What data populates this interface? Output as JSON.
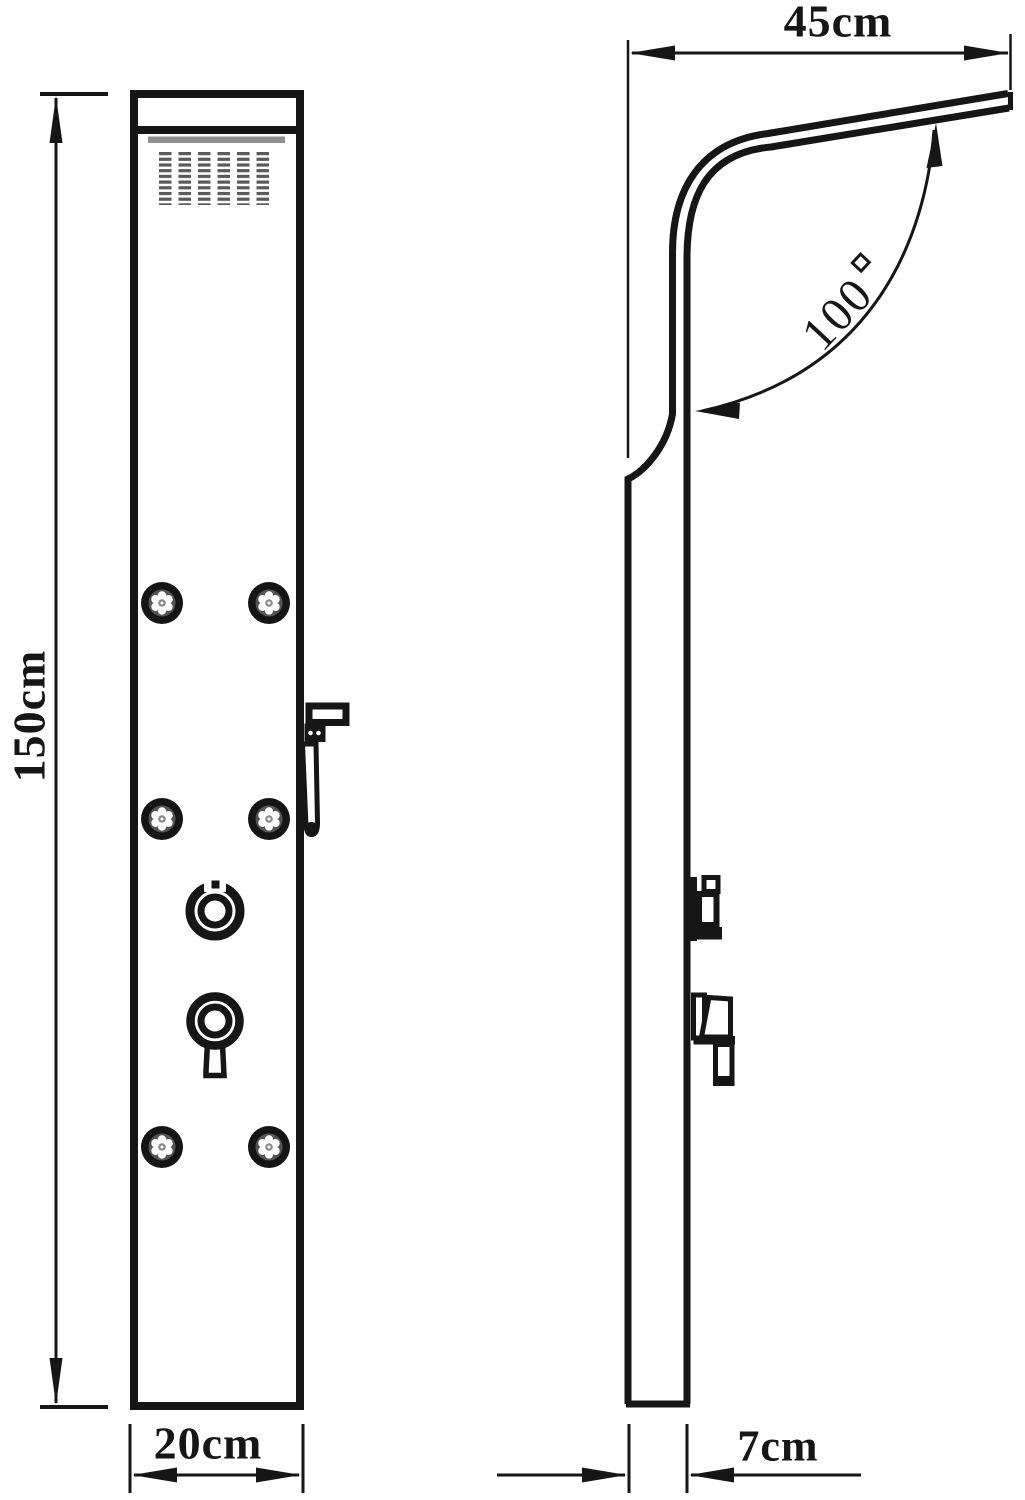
{
  "labels": {
    "height": "150cm",
    "width": "20cm",
    "arm_length": "45cm",
    "angle_degrees": "100",
    "angle": "100°",
    "depth": "7cm"
  },
  "colors": {
    "line": "#161616",
    "background": "#ffffff",
    "accent_gray": "#8f8f8f",
    "nozzle_gray": "#5a5a5a"
  }
}
